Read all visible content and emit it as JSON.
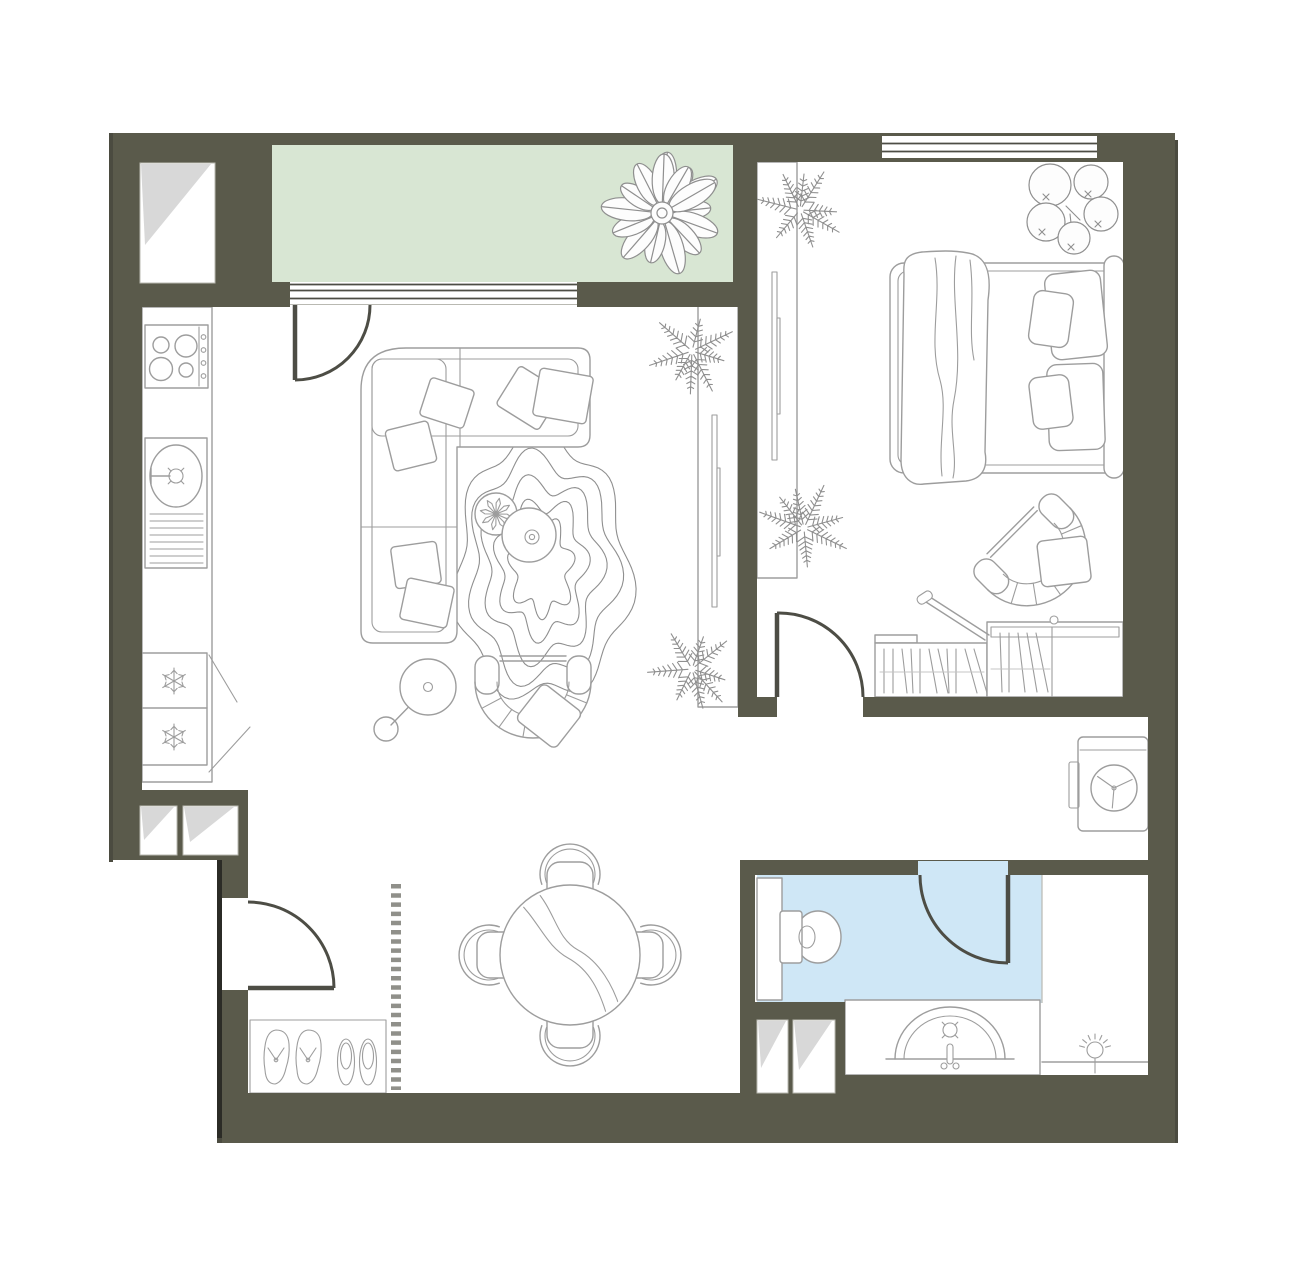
{
  "plan": {
    "title": "apartment-floor-plan",
    "colors": {
      "wall": "#5a5a4b",
      "floor": "#ffffff",
      "balcony": "#d8e6d3",
      "bath": "#cfe7f6",
      "line": "#9d9d9d",
      "plant": "#8f8f8f",
      "door": "#4d4d45",
      "fold": "#d8d8d8",
      "dash": "#90908a",
      "shadow": "#4b4b40",
      "shadow2": "#2b2b26"
    },
    "rooms": [
      "balcony",
      "living-room-with-kitchen",
      "bedroom",
      "hallway",
      "corridor",
      "bathroom"
    ],
    "fixtures": [
      "balcony-palm-plant",
      "balcony-window",
      "balcony-door",
      "kitchen-counter",
      "stove-4-burners",
      "kitchen-sink",
      "fridge-freezer",
      "corner-sofa",
      "throw-pillows",
      "wavy-rug",
      "coffee-table-small-with-plant",
      "coffee-table-round",
      "floor-lamp",
      "tub-armchair",
      "console-shelf-living",
      "fern-plants",
      "dining-table-round",
      "dining-chairs-4",
      "shoe-mat",
      "flip-flops",
      "slippers",
      "entrance-door",
      "hall-dashed-boundary",
      "vent-shafts",
      "bedroom-window",
      "double-bed",
      "blanket",
      "bed-pillows",
      "eucalyptus-plant",
      "wardrobe-bedroom",
      "storage-chest-open-lid",
      "bedroom-armchair",
      "bedroom-door",
      "washing-machine",
      "bathroom-door",
      "toilet",
      "bathroom-cabinet",
      "vanity-with-semicircle-sink",
      "shower-zone"
    ]
  }
}
